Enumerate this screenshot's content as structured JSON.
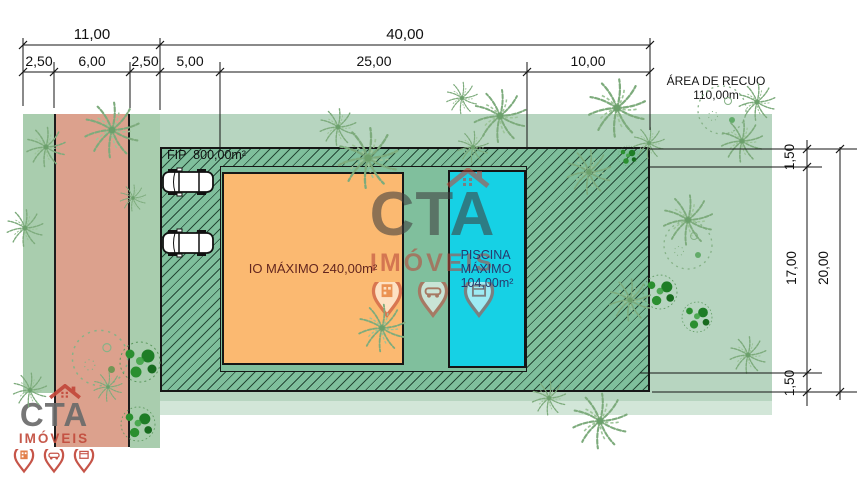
{
  "plan": {
    "fip_label": "FIP  800,00m²",
    "house_label": "IO MÁXIMO 240,00m²",
    "pool_label_line1": "PISCINA",
    "pool_label_line2": "MÁXIMO",
    "pool_label_line3": "104,00m²",
    "recuo_line1": "ÁREA DE RECUO",
    "recuo_line2": "110,00m"
  },
  "dimensions": {
    "top_total_left": "11,00",
    "top_total_right": "40,00",
    "sub_1": "2,50",
    "sub_2": "6,00",
    "sub_3": "2,50",
    "sub_4": "5,00",
    "sub_5": "25,00",
    "sub_6": "10,00",
    "right_top_setback": "1,50",
    "right_inner": "17,00",
    "right_total": "20,00",
    "right_bottom_setback": "1,50"
  },
  "watermark": {
    "brand": "CTA",
    "subtitle": "IMÓVEIS"
  },
  "logo": {
    "brand": "CTA",
    "subtitle": "IMÓVEIS"
  },
  "colors": {
    "terrain": "#b7d5c0",
    "sidewalk": "#a9cdae",
    "road": "#dca18d",
    "lot_green": "#7fbf9c",
    "house_orange": "#fbb971",
    "pool_cyan": "#16d1e5",
    "house_text": "#63261f",
    "pool_text": "#273a6e",
    "brand_red": "#c24b3c",
    "brand_gray": "#5a5a5a"
  }
}
